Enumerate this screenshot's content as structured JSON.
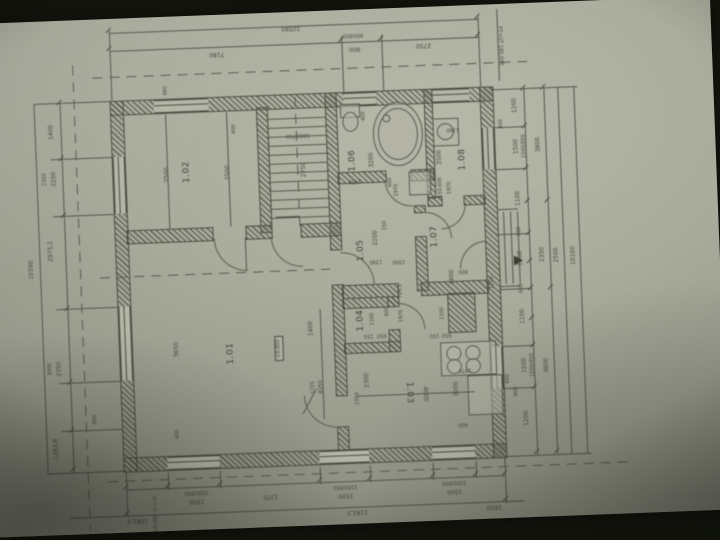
{
  "colors": {
    "paper": "#a9ab9c",
    "ink": "#4b4e40",
    "background": "#14160e"
  },
  "labels": {
    "top_total": "10590",
    "top_d1": "7180",
    "top_w1": "900/850",
    "top_d2": "900",
    "top_d3": "2750",
    "corner_note": "PT=UT 180,000",
    "datum_note": "±0,000 m n.m.",
    "level_mark": "±0,000",
    "left_total": "10590",
    "left_d1": "1400",
    "left_d2": "2350",
    "left_d3": "2200",
    "left_d4": "2975,1",
    "left_d5": "3000",
    "left_d6": "2350",
    "left_d7": "900",
    "left_d8": "1283,9",
    "right_a1": "1200",
    "right_w1": "1500/850",
    "right_a2": "1500",
    "right_a3": "1100",
    "right_a4": "600",
    "right_a5": "1300",
    "right_a6": "600",
    "right_a7": "1100",
    "right_w2": "1500/850",
    "right_a8": "1500",
    "right_a9": "1200",
    "right_s1": "400",
    "right_s2": "900",
    "right_s3": "400",
    "right_b1": "3800",
    "right_b2": "2350",
    "right_b3": "3800",
    "right_c1": "2500",
    "right_total": "10100",
    "bottom_e1": "1082,5",
    "bottom_w1": "1500/850",
    "bottom_d1": "1500",
    "bottom_d2": "1375",
    "bottom_w2": "1500/850",
    "bottom_d3": "1500",
    "bottom_w3": "1500/850",
    "bottom_d4": "1500",
    "bottom_e2": "2162,5",
    "bottom_e3": "1650",
    "room_1_01": "1.01",
    "room_1_02": "1.02",
    "room_1_03": "1.03",
    "room_1_04": "1.04",
    "room_1_05": "1.05",
    "room_1_06": "1.06",
    "room_1_07": "1.07",
    "room_1_08": "1.08",
    "i_2500a": "2500",
    "i_2500b": "2500",
    "i_480": "480",
    "i_400a": "400",
    "i_2750": "2750",
    "i_1000_750": "1000/750",
    "i_400b": "400",
    "i_3200": "3200",
    "i_1450": "1450",
    "i_600a": "600",
    "i_1970a": "1970",
    "i_150_600": "150,600",
    "i_1390a": "1390",
    "i_3500": "3500",
    "i_1970b": "1970",
    "i_2200": "2200",
    "i_150a": "150",
    "i_1390b": "1390",
    "i_1500": "1500",
    "i_2800": "2800",
    "i_800": "800",
    "i_1250": "1250",
    "i_1100a": "1100",
    "i_150b": "150",
    "i_650a": "650",
    "i_705_1": "705,1",
    "i_1100b": "1100",
    "i_600b": "600",
    "i_1970c": "1970",
    "i_4000": "4000",
    "i_3000": "3000",
    "i_2300": "2300",
    "i_2350": "2350",
    "i_1970d": "1970",
    "i_400c": "400",
    "i_150c": "150",
    "i_650b": "650",
    "i_3650": "3650",
    "i_1400": "1400",
    "i_1725": "1725",
    "i_o250": "Ø250",
    "i_400d": "400"
  }
}
